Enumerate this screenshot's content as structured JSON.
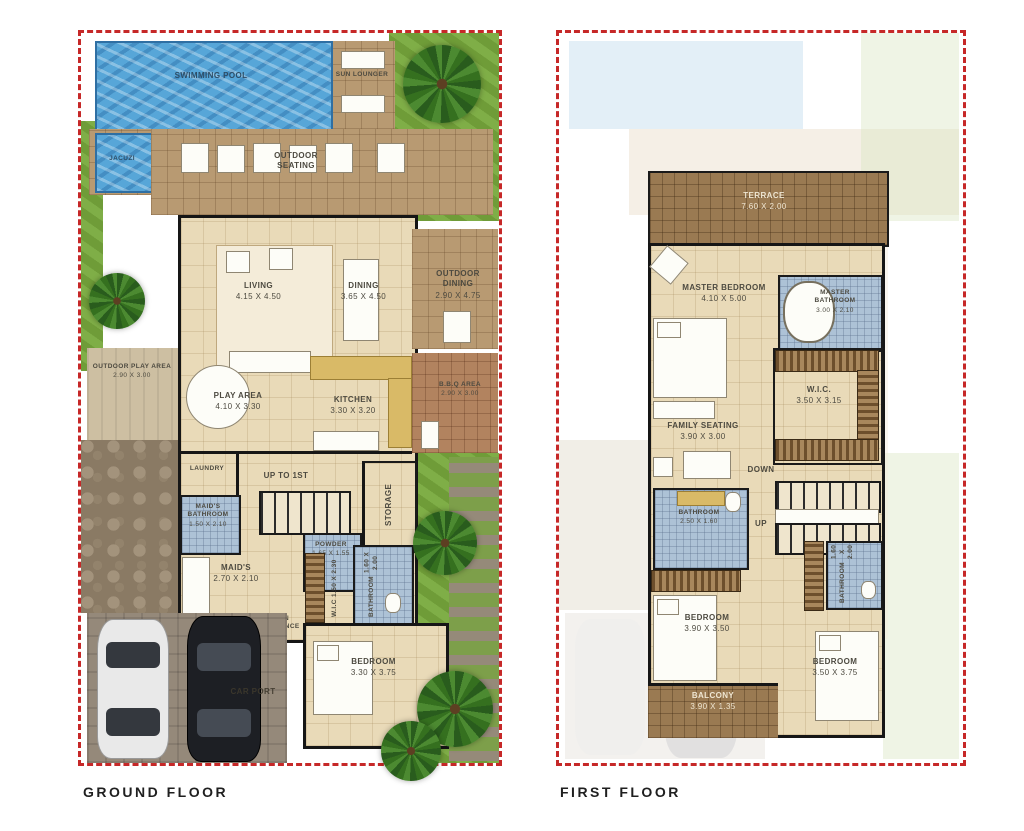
{
  "ground": {
    "title": "GROUND FLOOR",
    "rooms": {
      "swimming_pool": {
        "name": "SWIMMING POOL"
      },
      "sun_lounger": {
        "name": "SUN LOUNGER"
      },
      "jacuzzi": {
        "name": "JACUZI"
      },
      "outdoor_seating": {
        "name": "OUTDOOR SEATING"
      },
      "living": {
        "name": "LIVING",
        "dims": "4.15 X 4.50"
      },
      "dining": {
        "name": "DINING",
        "dims": "3.65 X 4.50"
      },
      "outdoor_dining": {
        "name": "OUTDOOR DINING",
        "dims": "2.90 X 4.75"
      },
      "outdoor_play": {
        "name": "OUTDOOR PLAY AREA",
        "dims": "2.90 X 3.00"
      },
      "play_area": {
        "name": "PLAY AREA",
        "dims": "4.10 X 3.30"
      },
      "kitchen": {
        "name": "KITCHEN",
        "dims": "3.30 X 3.20"
      },
      "bbq": {
        "name": "B.B.Q AREA",
        "dims": "2.90 X 3.00"
      },
      "laundry": {
        "name": "LAUNDRY"
      },
      "maids_bathroom": {
        "name": "MAID'S BATHROOM",
        "dims": "1.50 X 2.10"
      },
      "stairs": {
        "name": "UP TO 1ST"
      },
      "powder": {
        "name": "POWDER",
        "dims": "1.65 X 1.55"
      },
      "storage": {
        "name": "STORAGE"
      },
      "maids_room": {
        "name": "MAID'S",
        "dims": "2.70 X 2.10"
      },
      "wic": {
        "name": "W.I.C",
        "dims": "1.50 X 2.30"
      },
      "bathroom": {
        "name": "BATHROOM",
        "dims": "1.60 X 2.00"
      },
      "main_entrance": {
        "name": "MAIN ENTRANCE"
      },
      "bedroom": {
        "name": "BEDROOM",
        "dims": "3.30 X 3.75"
      },
      "car_port": {
        "name": "CAR PORT"
      }
    }
  },
  "first": {
    "title": "FIRST FLOOR",
    "rooms": {
      "terrace": {
        "name": "TERRACE",
        "dims": "7.60 X 2.00"
      },
      "master_bedroom": {
        "name": "MASTER BEDROOM",
        "dims": "4.10 X 5.00"
      },
      "master_bathroom": {
        "name": "MASTER BATHROOM",
        "dims": "3.00 X 2.10"
      },
      "wic": {
        "name": "W.I.C.",
        "dims": "3.50 X 3.15"
      },
      "family_seating": {
        "name": "FAMILY SEATING",
        "dims": "3.90 X 3.00"
      },
      "down": {
        "name": "DOWN"
      },
      "up": {
        "name": "UP"
      },
      "bathroom_left": {
        "name": "BATHROOM",
        "dims": "2.50 X 1.60"
      },
      "bedroom_left": {
        "name": "BEDROOM",
        "dims": "3.90 X 3.50"
      },
      "bathroom_right": {
        "name": "BATHROOM",
        "dims": "1.60 X 2.00"
      },
      "bedroom_right": {
        "name": "BEDROOM",
        "dims": "3.50 X 3.75"
      },
      "balcony": {
        "name": "BALCONY",
        "dims": "3.90 X 1.35"
      }
    }
  },
  "colors": {
    "boundary_red": "#c62828",
    "pool_blue": "#57a6d8",
    "grass_green": "#76a13e",
    "deck_tan": "#b89a72",
    "bath_blue": "#adc2d6",
    "wall_black": "#161616"
  }
}
